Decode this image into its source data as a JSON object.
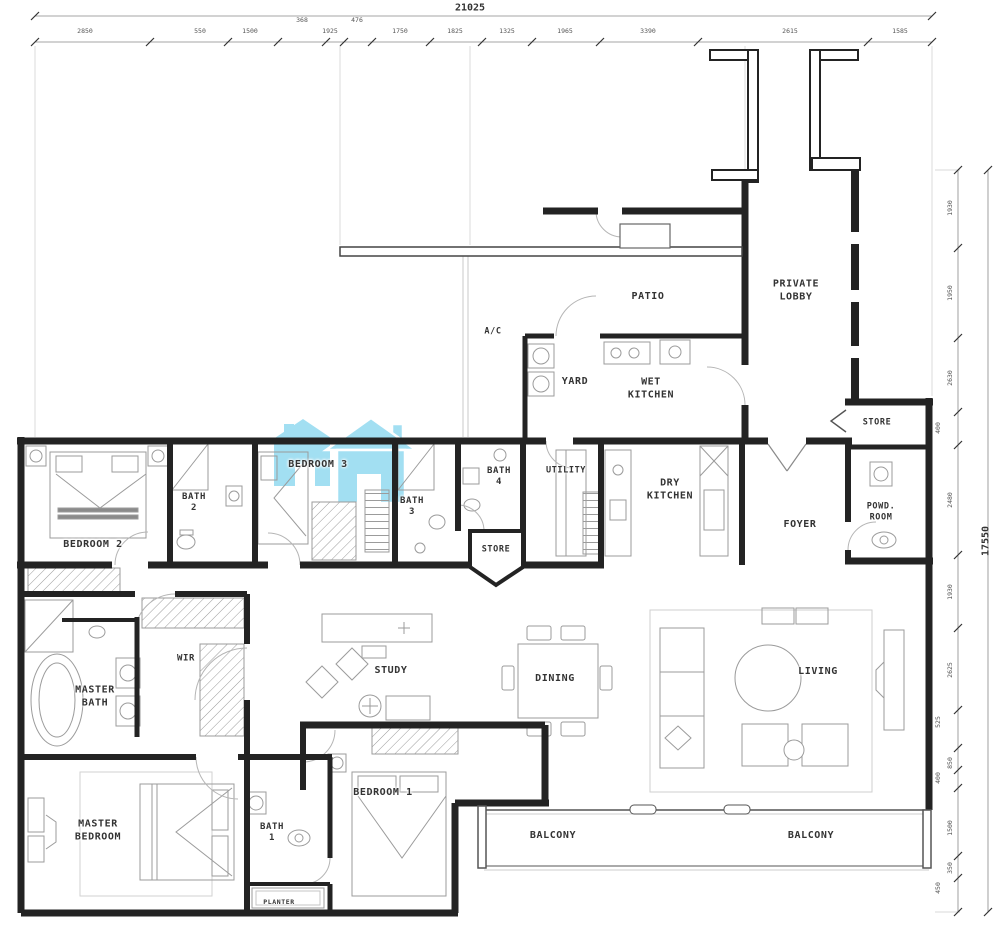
{
  "plan": {
    "watermark_color": "#8ed8f0",
    "rooms": [
      {
        "id": "patio",
        "label": "PATIO"
      },
      {
        "id": "private-lobby",
        "label": "PRIVATE\nLOBBY"
      },
      {
        "id": "ac",
        "label": "A/C"
      },
      {
        "id": "yard",
        "label": "YARD"
      },
      {
        "id": "wet-kitchen",
        "label": "WET\nKITCHEN"
      },
      {
        "id": "store-upper",
        "label": "STORE"
      },
      {
        "id": "bedroom-3",
        "label": "BEDROOM 3"
      },
      {
        "id": "bath-2",
        "label": "BATH\n2"
      },
      {
        "id": "bath-3",
        "label": "BATH\n3"
      },
      {
        "id": "bath-4",
        "label": "BATH\n4"
      },
      {
        "id": "utility",
        "label": "UTILITY"
      },
      {
        "id": "dry-kitchen",
        "label": "DRY\nKITCHEN"
      },
      {
        "id": "foyer",
        "label": "FOYER"
      },
      {
        "id": "powd-room",
        "label": "POWD.\nROOM"
      },
      {
        "id": "bedroom-2",
        "label": "BEDROOM 2"
      },
      {
        "id": "store-mid",
        "label": "STORE"
      },
      {
        "id": "wir",
        "label": "WIR"
      },
      {
        "id": "master-bath",
        "label": "MASTER\nBATH"
      },
      {
        "id": "study",
        "label": "STUDY"
      },
      {
        "id": "dining",
        "label": "DINING"
      },
      {
        "id": "living",
        "label": "LIVING"
      },
      {
        "id": "master-bedroom",
        "label": "MASTER\nBEDROOM"
      },
      {
        "id": "bath-1",
        "label": "BATH\n1"
      },
      {
        "id": "bedroom-1",
        "label": "BEDROOM  1"
      },
      {
        "id": "balcony-left",
        "label": "BALCONY"
      },
      {
        "id": "balcony-right",
        "label": "BALCONY"
      },
      {
        "id": "planter",
        "label": "PLANTER"
      }
    ]
  },
  "dimensions": {
    "top_total": "21025",
    "right_total": "17550",
    "top_segments": [
      "2850",
      "550",
      "1500",
      "368",
      "1925",
      "476",
      "1750",
      "1825",
      "1325",
      "1965",
      "3390",
      "2615",
      "1585"
    ],
    "right_segments": [
      "1930",
      "1950",
      "2630",
      "400",
      "2480",
      "1930",
      "2625",
      "525",
      "850",
      "400",
      "1500",
      "350",
      "450"
    ]
  }
}
